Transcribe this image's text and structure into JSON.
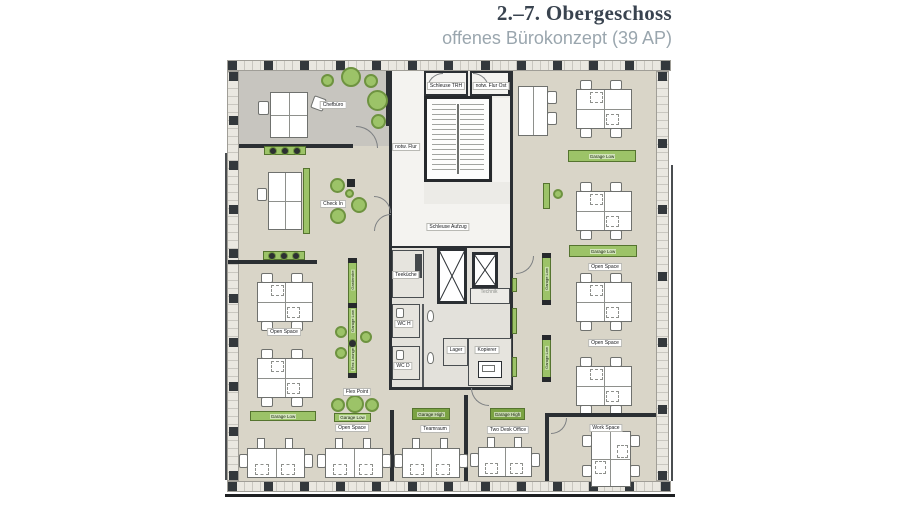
{
  "header": {
    "title": "2.–7. Obergeschoss",
    "subtitle": "offenes Bürokonzept (39 AP)"
  },
  "colors": {
    "title": "#39434f",
    "subtitle": "#9aa6ae",
    "wall": "#2b2f33",
    "floor": "#d9d5c8",
    "chef_floor": "#c7c5bf",
    "core_floor": "#ecebe7",
    "accent_green": "#9cc368",
    "dark_green": "#7ba344"
  },
  "labels": {
    "chefbuero": "Chefbüro",
    "check_in": "Check In",
    "notw_flur": "notw. Flur",
    "schleuse_trh": "Schleuse TRH",
    "notw_flur_ost": "notw. Flur Ost",
    "schleuse_aufzug": "Schleuse Aufzug",
    "technik": "Technik",
    "teekueche": "Teeküche",
    "wc_h": "WC H",
    "wc_d": "WC D",
    "lager": "Lager",
    "kopierer": "Kopierer",
    "open_space": "Open Space",
    "garage_low": "Garage Low",
    "garage_high": "Garage High",
    "garderobe": "Garderobe",
    "flex_lounge": "Flex Lounge",
    "flex_point": "Flex Point",
    "teamraum": "Teamraum",
    "two_desk_office": "Two Desk Office",
    "work_space": "Work Space"
  }
}
